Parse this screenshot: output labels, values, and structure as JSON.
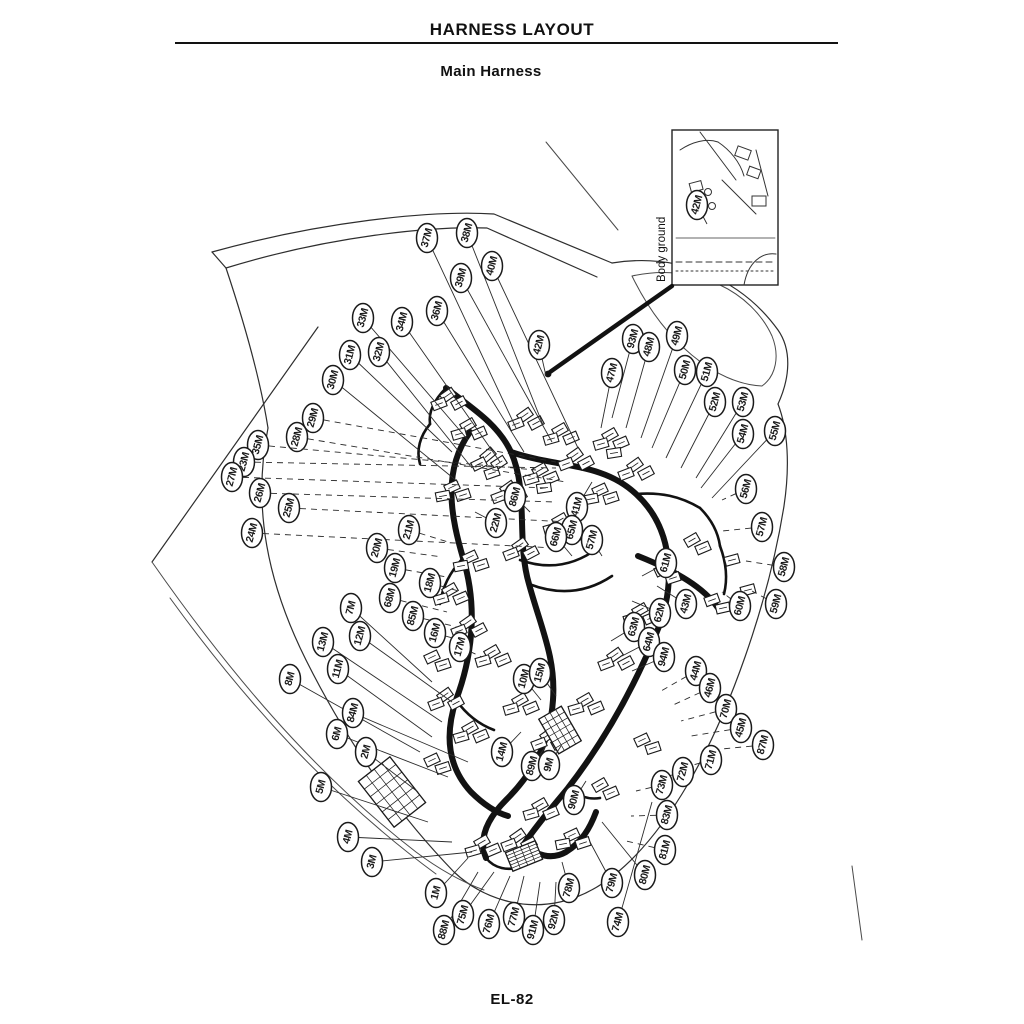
{
  "page": {
    "header_title": "HARNESS LAYOUT",
    "subtitle": "Main Harness",
    "page_number": "EL-82"
  },
  "colors": {
    "ink": "#1a1a1a",
    "leader": "#2b2b2b",
    "paper": "#ffffff"
  },
  "inset": {
    "caption": "Body ground",
    "label": "42M"
  },
  "diagram": {
    "description": "Main harness layout line drawing with oval connector callouts",
    "labels": [
      [
        "37M",
        427,
        238,
        516,
        428,
        0
      ],
      [
        "38M",
        467,
        233,
        543,
        425,
        0
      ],
      [
        "39M",
        461,
        278,
        552,
        442,
        0
      ],
      [
        "40M",
        492,
        266,
        578,
        448,
        0
      ],
      [
        "36M",
        437,
        311,
        524,
        452,
        0
      ],
      [
        "34M",
        402,
        322,
        500,
        462,
        0
      ],
      [
        "33M",
        363,
        318,
        468,
        440,
        0
      ],
      [
        "32M",
        379,
        352,
        472,
        468,
        0
      ],
      [
        "31M",
        350,
        355,
        452,
        452,
        0
      ],
      [
        "30M",
        333,
        380,
        458,
        482,
        0
      ],
      [
        "29M",
        313,
        418,
        556,
        462,
        1
      ],
      [
        "28M",
        297,
        437,
        566,
        482,
        1
      ],
      [
        "35M",
        258,
        445,
        536,
        470,
        1
      ],
      [
        "23M",
        244,
        462,
        556,
        468,
        1
      ],
      [
        "27M",
        232,
        477,
        550,
        488,
        1
      ],
      [
        "26M",
        260,
        493,
        556,
        502,
        1
      ],
      [
        "25M",
        289,
        508,
        570,
        522,
        1
      ],
      [
        "24M",
        252,
        533,
        556,
        548,
        1
      ],
      [
        "21M",
        409,
        530,
        448,
        542,
        1
      ],
      [
        "22M",
        496,
        523,
        475,
        512,
        0
      ],
      [
        "20M",
        377,
        548,
        442,
        557,
        1
      ],
      [
        "19M",
        395,
        568,
        447,
        577,
        1
      ],
      [
        "18M",
        430,
        583,
        462,
        592,
        1
      ],
      [
        "68M",
        390,
        598,
        447,
        612,
        1
      ],
      [
        "85M",
        413,
        616,
        457,
        627,
        1
      ],
      [
        "16M",
        435,
        633,
        466,
        642,
        1
      ],
      [
        "17M",
        460,
        647,
        482,
        657,
        1
      ],
      [
        "7M",
        351,
        608,
        432,
        682,
        0
      ],
      [
        "12M",
        360,
        636,
        452,
        702,
        0
      ],
      [
        "13M",
        323,
        642,
        442,
        722,
        0
      ],
      [
        "11M",
        338,
        669,
        432,
        737,
        0
      ],
      [
        "8M",
        290,
        679,
        420,
        752,
        0
      ],
      [
        "84M",
        353,
        713,
        468,
        762,
        0
      ],
      [
        "6M",
        337,
        734,
        448,
        777,
        0
      ],
      [
        "2M",
        366,
        752,
        418,
        792,
        0
      ],
      [
        "5M",
        321,
        787,
        428,
        822,
        0
      ],
      [
        "4M",
        348,
        837,
        452,
        842,
        0
      ],
      [
        "3M",
        372,
        862,
        472,
        852,
        0
      ],
      [
        "1M",
        436,
        893,
        468,
        858,
        0
      ],
      [
        "88M",
        444,
        930,
        478,
        872,
        0
      ],
      [
        "75M",
        463,
        915,
        494,
        872,
        0
      ],
      [
        "76M",
        489,
        924,
        510,
        876,
        0
      ],
      [
        "77M",
        514,
        917,
        524,
        876,
        0
      ],
      [
        "91M",
        533,
        930,
        540,
        882,
        0
      ],
      [
        "92M",
        554,
        920,
        556,
        882,
        0
      ],
      [
        "78M",
        569,
        888,
        562,
        862,
        0
      ],
      [
        "79M",
        612,
        883,
        590,
        842,
        0
      ],
      [
        "80M",
        645,
        875,
        602,
        822,
        0
      ],
      [
        "74M",
        618,
        922,
        652,
        802,
        0
      ],
      [
        "42M",
        539,
        345,
        546,
        376,
        0
      ],
      [
        "86M",
        515,
        497,
        530,
        512,
        0
      ],
      [
        "41M",
        577,
        507,
        592,
        482,
        0
      ],
      [
        "65M",
        572,
        530,
        586,
        546,
        0
      ],
      [
        "66M",
        556,
        537,
        572,
        556,
        0
      ],
      [
        "57M",
        592,
        540,
        602,
        556,
        0
      ],
      [
        "10M",
        524,
        679,
        541,
        700,
        0
      ],
      [
        "15M",
        540,
        673,
        556,
        696,
        0
      ],
      [
        "14M",
        502,
        752,
        521,
        732,
        0
      ],
      [
        "89M",
        532,
        766,
        546,
        746,
        0
      ],
      [
        "9M",
        549,
        765,
        561,
        746,
        0
      ],
      [
        "90M",
        574,
        800,
        586,
        781,
        0
      ],
      [
        "61M",
        666,
        563,
        642,
        576,
        0
      ],
      [
        "62M",
        660,
        613,
        632,
        601,
        0
      ],
      [
        "43M",
        686,
        604,
        657,
        586,
        0
      ],
      [
        "63M",
        634,
        627,
        611,
        641,
        0
      ],
      [
        "64M",
        649,
        642,
        622,
        656,
        0
      ],
      [
        "94M",
        664,
        657,
        632,
        671,
        0
      ],
      [
        "93M",
        633,
        339,
        612,
        418,
        0
      ],
      [
        "48M",
        649,
        347,
        626,
        428,
        0
      ],
      [
        "49M",
        677,
        336,
        641,
        438,
        0
      ],
      [
        "47M",
        612,
        373,
        601,
        428,
        0
      ],
      [
        "50M",
        685,
        370,
        652,
        448,
        0
      ],
      [
        "51M",
        707,
        372,
        666,
        458,
        0
      ],
      [
        "52M",
        715,
        402,
        681,
        468,
        0
      ],
      [
        "53M",
        743,
        402,
        696,
        478,
        0
      ],
      [
        "54M",
        743,
        434,
        701,
        488,
        0
      ],
      [
        "55M",
        775,
        431,
        712,
        498,
        0
      ],
      [
        "56M",
        746,
        489,
        722,
        500,
        1
      ],
      [
        "57M",
        762,
        527,
        722,
        531,
        1
      ],
      [
        "58M",
        784,
        567,
        746,
        561,
        1
      ],
      [
        "59M",
        776,
        604,
        752,
        591,
        1
      ],
      [
        "60M",
        740,
        606,
        722,
        592,
        1
      ],
      [
        "44M",
        696,
        671,
        661,
        691,
        1
      ],
      [
        "46M",
        710,
        688,
        671,
        706,
        1
      ],
      [
        "70M",
        726,
        709,
        681,
        721,
        1
      ],
      [
        "45M",
        741,
        728,
        691,
        736,
        1
      ],
      [
        "87M",
        763,
        745,
        701,
        751,
        1
      ],
      [
        "71M",
        711,
        760,
        671,
        771,
        1
      ],
      [
        "72M",
        683,
        772,
        651,
        781,
        1
      ],
      [
        "73M",
        662,
        785,
        636,
        791,
        1
      ],
      [
        "83M",
        667,
        815,
        631,
        816,
        1
      ],
      [
        "81M",
        665,
        850,
        626,
        841,
        1
      ],
      [
        "42M",
        697,
        205,
        707,
        224,
        0
      ]
    ]
  }
}
